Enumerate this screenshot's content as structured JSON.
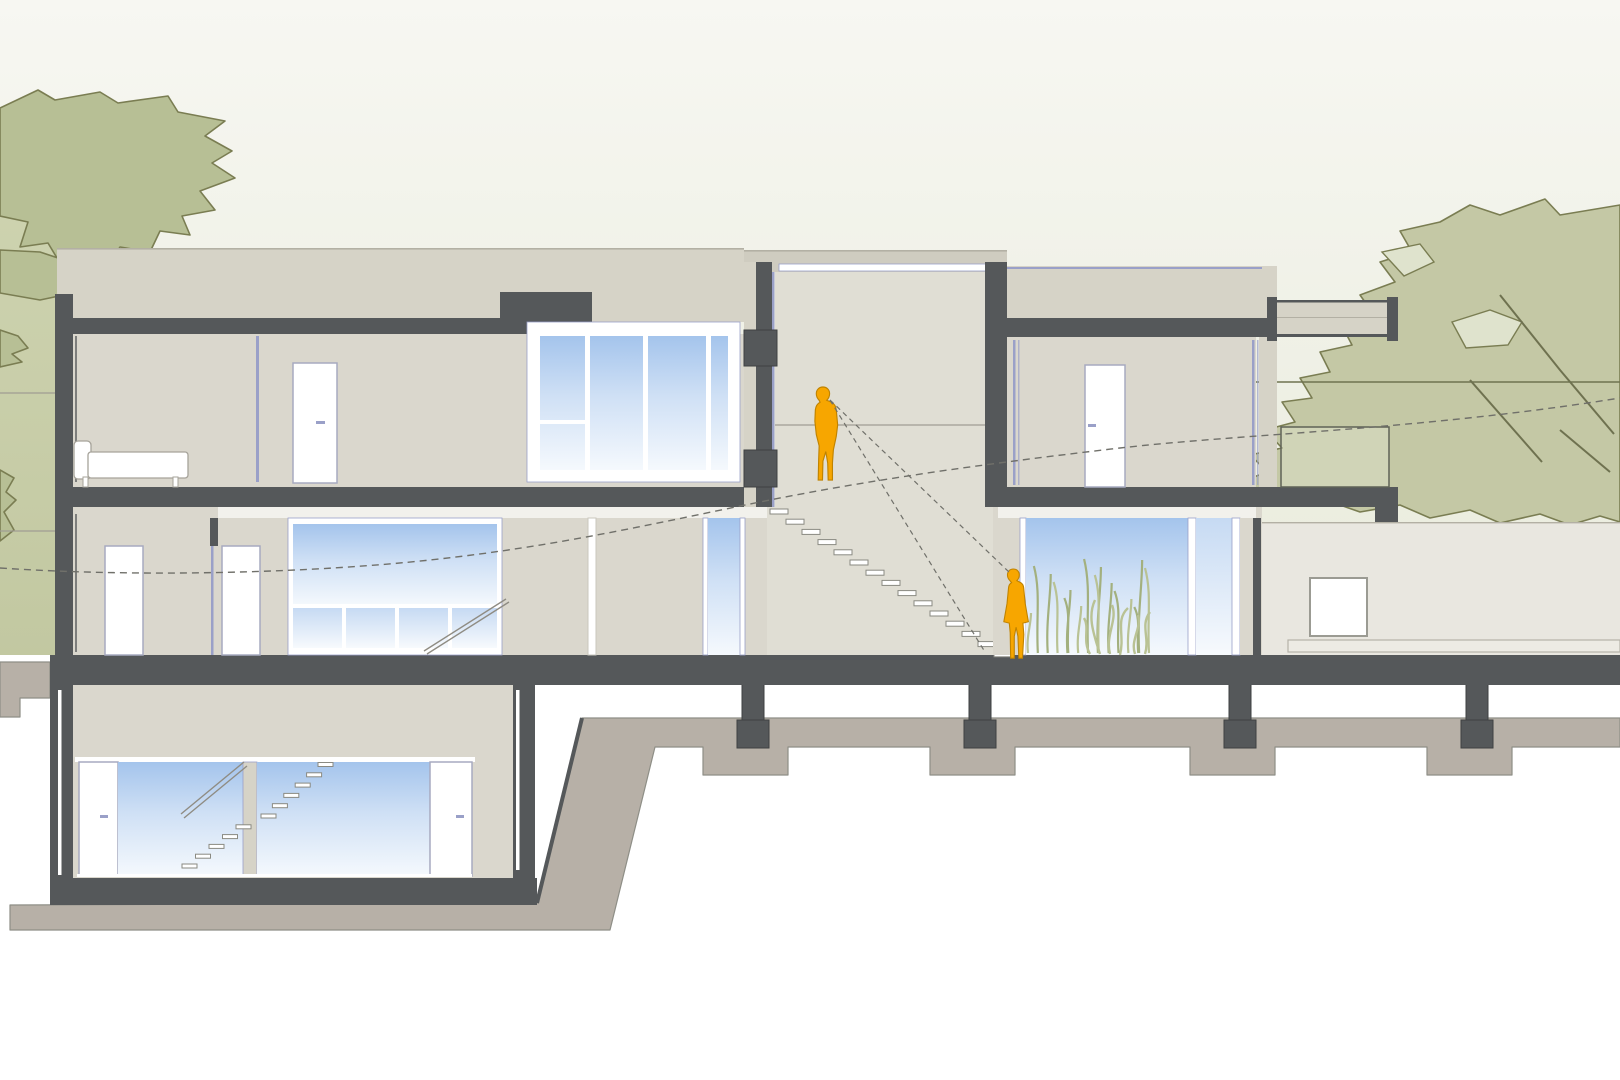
{
  "meta": {
    "type": "architectural-section-drawing",
    "subject": "Cross-section of a two-storey house with basement, central stair hall, garden terrace and background trees",
    "text_visible": false
  },
  "palette": {
    "poche": "#55585a",
    "pocheEdge": "#3e4142",
    "wallLight": "#d6d3c7",
    "wallBack": "#cfccc0",
    "roomFill": "#dad7cd",
    "hallFill": "#e0ded4",
    "terrace": "#e9e7e0",
    "soffit": "#f2f1ec",
    "white": "#ffffff",
    "glassTop": "#a4c4ec",
    "glassMid": "#cfe0f5",
    "glassBottom": "#f5f9fd",
    "glass2Top": "#c6daf3",
    "glass2Bottom": "#f7fafd",
    "frameLavender": "#9aa0c8",
    "doorOutline": "#a7aac0",
    "figure": "#f7a600",
    "figureStroke": "#c08300",
    "treeLeft": "#b7bf95",
    "treeRight": "#c4c8a5",
    "treeStroke": "#7a7d52",
    "bandTop": "#ced3b0",
    "bandBottom": "#c2c8a1",
    "ground": "#b7b0a7",
    "groundStroke": "#8e8e86",
    "dash": "#70706a",
    "skyTop": "#f7f7f2",
    "skyBottom": "#dfe3cd",
    "treadStroke": "#8a8a82",
    "railStroke": "#8f8c83",
    "lineSoft": "#a09d93",
    "edgeLine": "#b3b0a4",
    "grass": "#a3b07e",
    "grassLight": "#b9c294",
    "horizon": "#6f7250",
    "ledgeFill": "#edebe4",
    "ledgeStroke": "#b5b2a8"
  },
  "figures": [
    {
      "name": "adult-figure-walking-hall",
      "color": "#f7a600"
    },
    {
      "name": "adult-figure-standing-garden-window",
      "color": "#f7a600"
    }
  ],
  "stairs": {
    "hall": {
      "count": 15,
      "x0": 770,
      "y0": 509,
      "dx": 16.0,
      "dy": 10.2,
      "w": 18,
      "h": 5
    },
    "basement_upper_run": {
      "count": 6,
      "x0": 261,
      "y0": 814,
      "dx": 11.4,
      "dy": -10.3,
      "w": 15,
      "h": 4
    },
    "basement_lower_run": {
      "count": 5,
      "x0": 182,
      "y0": 864,
      "dx": 13.5,
      "dy": -9.8,
      "w": 15,
      "h": 4
    }
  },
  "grass": {
    "count": 16,
    "x0": 1032,
    "x1": 1150,
    "yBase": 653,
    "hMin": 40,
    "hMax": 95
  },
  "trees": [
    {
      "name": "tree-left"
    },
    {
      "name": "tree-right"
    }
  ],
  "foundation": {
    "pier_centers": [
      753,
      980,
      1240,
      1477
    ]
  }
}
